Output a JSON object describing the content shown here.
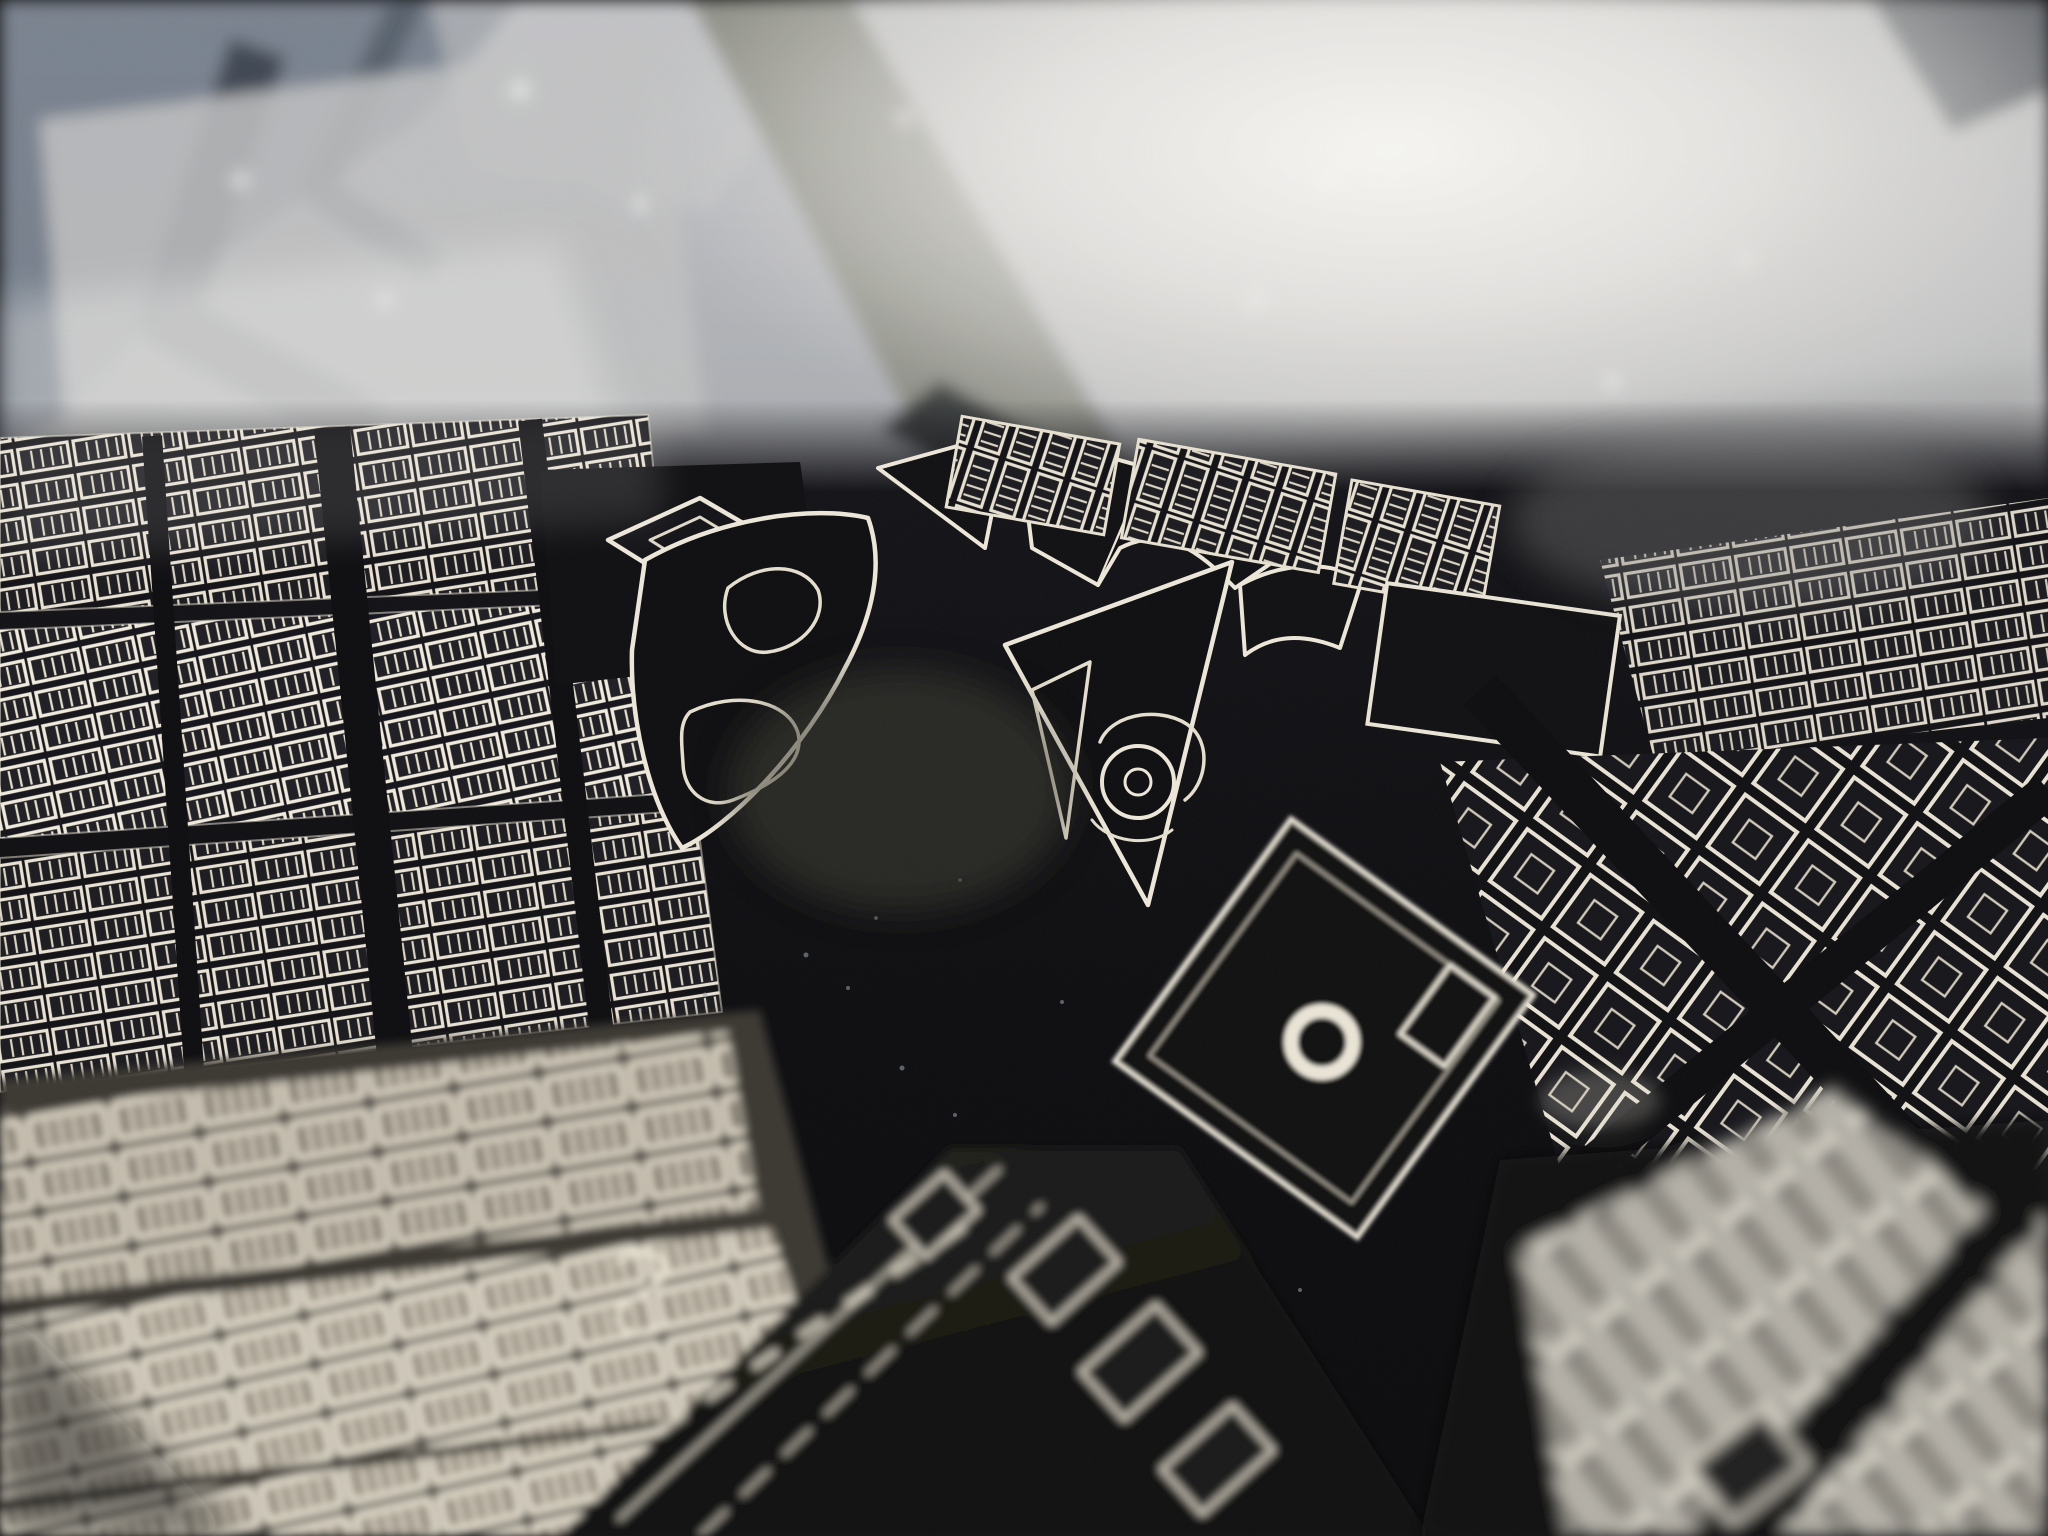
{
  "scene": {
    "title": "Macro photograph of an engraved metal city map",
    "description": "Low-angle close-up photograph of a street map engraved in silver on glossy black metal. A sharp focus band crosses the middle showing outlined city blocks, two ornamental parks with curved paths, a circular pond ring, a courtyard block with a large ring, and wide black diagonal streets and canals. The top of the frame is out of focus and washed out by bright light reflections with a bluish zig-zag canal at the upper left; the foreground rows of buildings at the bottom are close to the lens and blurred.",
    "visible_text": []
  },
  "palette": {
    "metal_black": "#0b0b0d",
    "metal_black_sheen": "#1a1b20",
    "engraving_bright": "#f0eadc",
    "engraving_warm": "#d9d2c2",
    "far_haze_gray": "#aeb0b4",
    "far_shadow_blue": "#39404c",
    "canal_olive_gray": "#85867b",
    "washout_white": "#f6f5f2",
    "near_street_umber": "#38342e",
    "junction_glow_brown": "#3d3a2f"
  },
  "regions": {
    "far_background": {
      "label": "out-of-focus blurred city blocks, bright reflections, zig-zag canal (background)"
    },
    "focus_band": {
      "label": "in-focus engraved city blocks, streets and parks (middle band)"
    },
    "park_left": {
      "label": "park with curved paths and flower-bed shapes"
    },
    "park_right": {
      "label": "triangular park with circular pond ring"
    },
    "plaza_ring": {
      "label": "courtyard block containing a large engraved ring"
    },
    "near_foreground": {
      "label": "close, slightly blurred rows of buildings and black canal"
    },
    "near_foreground_corner": {
      "label": "strongly blurred bright building rows, bottom-right corner"
    }
  }
}
